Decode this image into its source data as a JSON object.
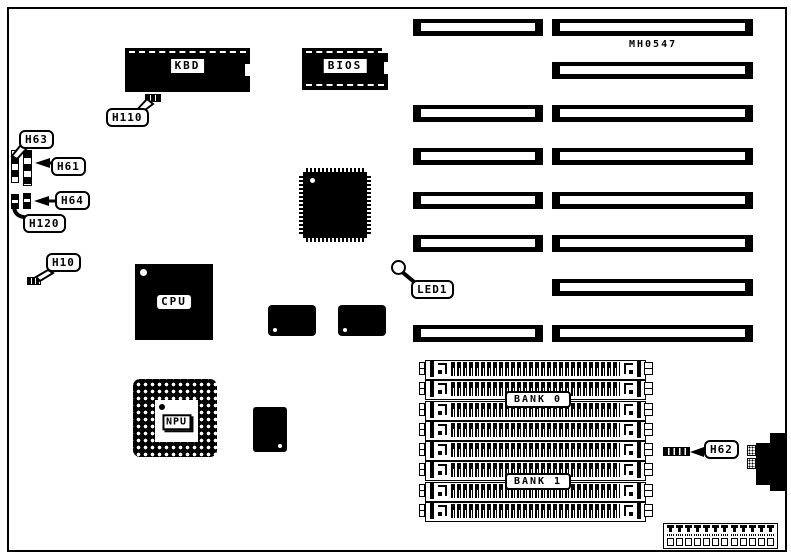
{
  "diagram": {
    "part_number": "MH0547",
    "chips": {
      "kbd": "KBD",
      "bios": "BIOS",
      "cpu": "CPU",
      "npu": "NPU"
    },
    "connectors": {
      "h110": "H110",
      "h63": "H63",
      "h61": "H61",
      "h64": "H64",
      "h120": "H120",
      "h10": "H10",
      "h62": "H62",
      "led1": "LED1"
    },
    "memory": {
      "bank0_label": "BANK 0",
      "bank1_label": "BANK 1",
      "simm_socket_count": 8
    },
    "expansion": {
      "right_slot_count": 8,
      "left_slot_count": 6
    },
    "bottom_connector": {
      "pin_count": 12
    }
  },
  "colors": {
    "ink": "#000000",
    "paper": "#ffffff"
  }
}
